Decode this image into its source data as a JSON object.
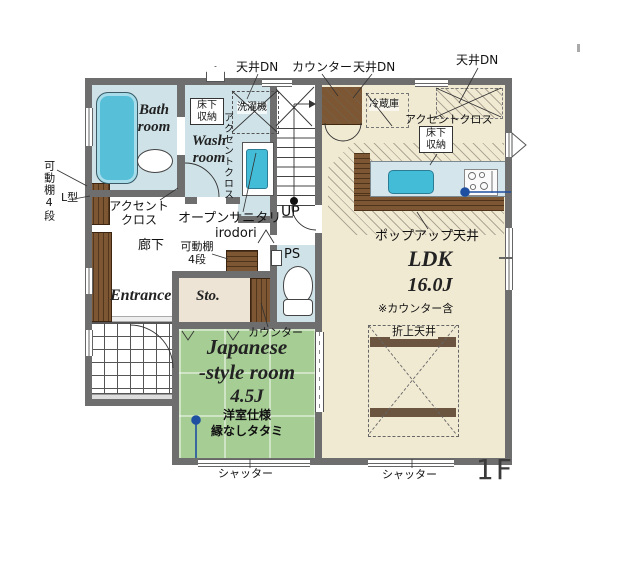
{
  "plan": {
    "floor_label": "1F",
    "rooms": {
      "bath": "Bath\nroom",
      "wash": "Wash\nroom",
      "hallway": "廊下",
      "entrance": "Entrance",
      "storage": "Sto.",
      "japanese_name": "Japanese",
      "japanese_name2": "-style room",
      "japanese_size": "4.5J",
      "japanese_note1": "洋室仕様",
      "japanese_note2": "縁なしタタミ",
      "ldk_name": "LDK",
      "ldk_size": "16.0J",
      "ldk_note": "※カウンター含"
    },
    "annotations": {
      "ceiling_dn": "天井DN",
      "counter": "カウンター",
      "underfloor_storage": "床下\n収納",
      "washing_machine": "洗濯機",
      "accent_cloth": "アクセントクロス",
      "accent_cloth_2line": "アクセント\nクロス",
      "open_sanitary": "オープンサニタリー",
      "open_sanitary_name": "irodori",
      "movable_shelf_2line": "可動棚\n4段",
      "movable_shelf": "可動棚4段",
      "l_type": "L型",
      "up": "UP",
      "ps": "PS",
      "refrigerator": "冷蔵庫",
      "popup_ceiling": "ポップアップ天井",
      "coffered_ceiling": "折上天井",
      "shutter": "シャッター"
    },
    "colors": {
      "wall": "#6e6e6e",
      "water_blue": "#cfe2e8",
      "fixture_teal": "#4fc0d8",
      "floor_beige": "#f1ead3",
      "tatami_green": "#a5cd94",
      "wood_brown": "#7d5733",
      "marker_blue": "#1e4fa0"
    }
  }
}
